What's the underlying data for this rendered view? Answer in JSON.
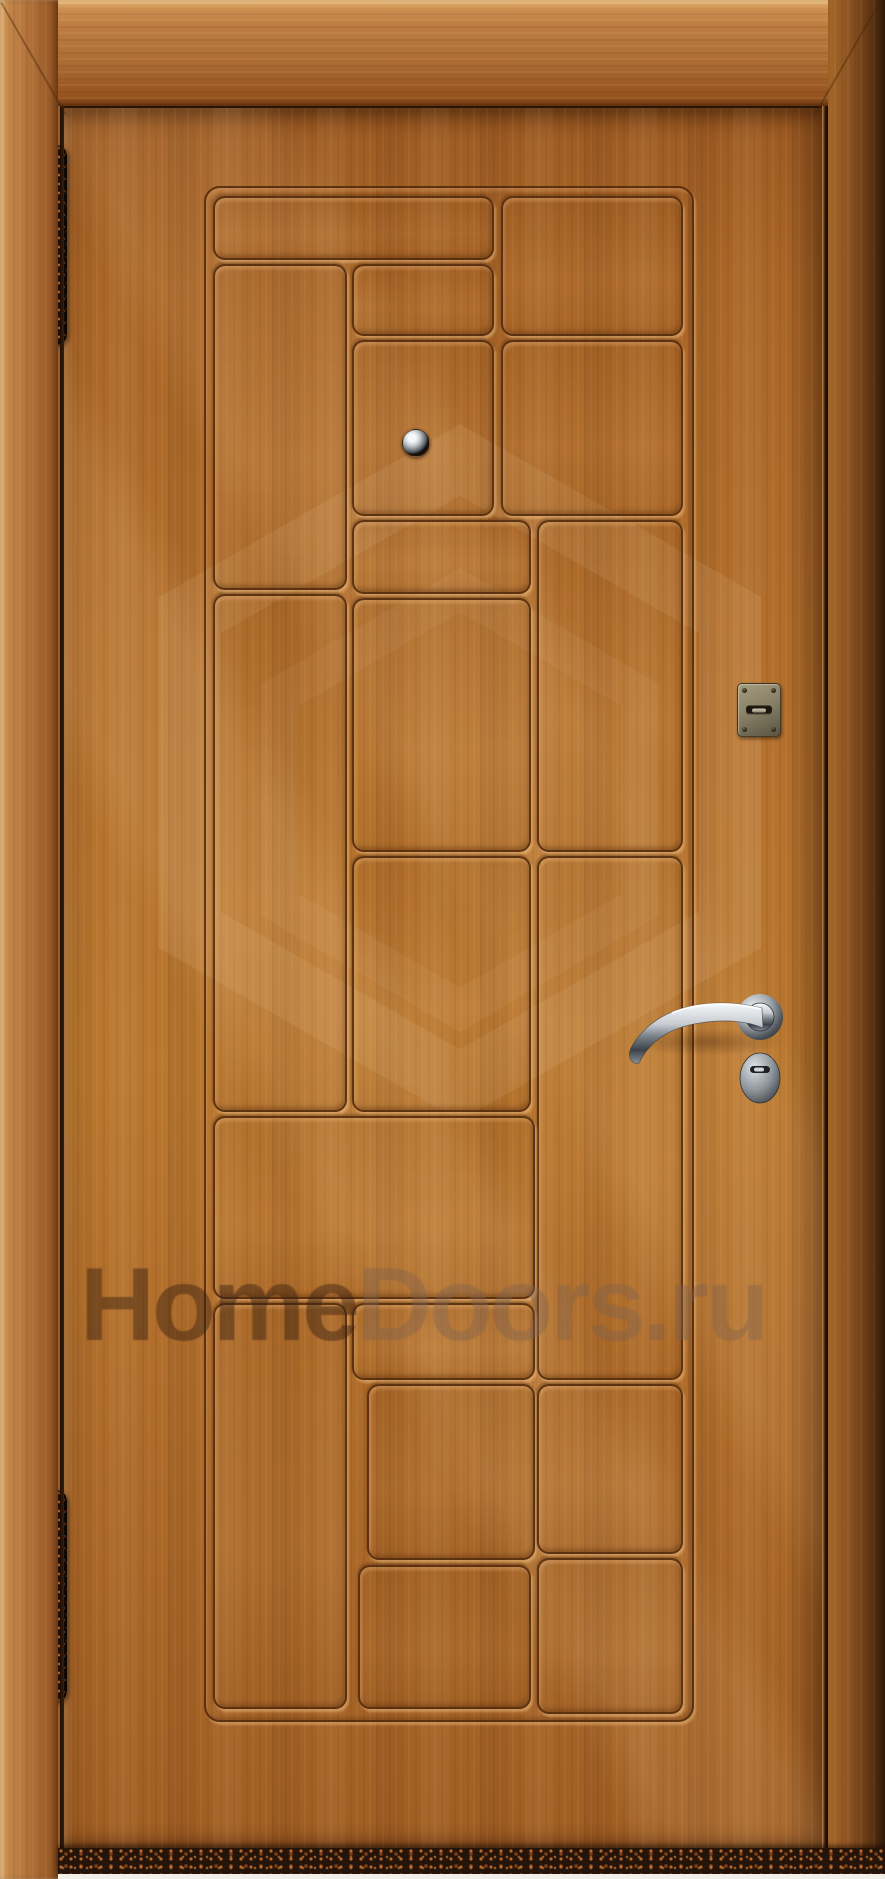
{
  "meta": {
    "subject": "Entrance door, golden-oak wood finish, decorative staggered rectangular panel pattern, front view product photo"
  },
  "watermark": {
    "text": "HomeDoors.ru",
    "primary": "Home",
    "secondary": "Doors.ru"
  },
  "palette": {
    "leaf_wood": "#b5722e",
    "frame_wood": "#b5753c",
    "groove_dark": "#542c0e",
    "groove_highlight": "#facA8c",
    "threshold_dark": "#241409",
    "threshold_speckle": "#c9702f",
    "chrome_light": "#f6f8f9",
    "chrome_dark": "#3c4248",
    "plate_metal": "#8b8368"
  },
  "layout": {
    "scene": {
      "x": 0,
      "y": 0,
      "w": 885,
      "h": 1879
    },
    "leaf": {
      "x": 64,
      "y": 108,
      "w": 759,
      "h": 1740
    },
    "outer_groove": {
      "x": 204,
      "y": 186,
      "w": 486,
      "h": 1532
    },
    "wm_text_pos": {
      "x": 80,
      "y": 1246
    },
    "threshold": {
      "x": 58,
      "y": 1848,
      "w": 827,
      "h": 26
    }
  },
  "panels": [
    {
      "x": 213,
      "y": 196,
      "w": 277,
      "h": 60
    },
    {
      "x": 501,
      "y": 196,
      "w": 178,
      "h": 136
    },
    {
      "x": 213,
      "y": 264,
      "w": 130,
      "h": 322
    },
    {
      "x": 352,
      "y": 264,
      "w": 138,
      "h": 68
    },
    {
      "x": 352,
      "y": 340,
      "w": 138,
      "h": 172
    },
    {
      "x": 501,
      "y": 340,
      "w": 178,
      "h": 172
    },
    {
      "x": 352,
      "y": 520,
      "w": 175,
      "h": 70
    },
    {
      "x": 537,
      "y": 520,
      "w": 142,
      "h": 328
    },
    {
      "x": 213,
      "y": 594,
      "w": 130,
      "h": 514
    },
    {
      "x": 352,
      "y": 598,
      "w": 175,
      "h": 250
    },
    {
      "x": 352,
      "y": 856,
      "w": 175,
      "h": 252
    },
    {
      "x": 537,
      "y": 856,
      "w": 142,
      "h": 520
    },
    {
      "x": 213,
      "y": 1116,
      "w": 318,
      "h": 179
    },
    {
      "x": 213,
      "y": 1303,
      "w": 130,
      "h": 402
    },
    {
      "x": 352,
      "y": 1303,
      "w": 179,
      "h": 73
    },
    {
      "x": 367,
      "y": 1384,
      "w": 164,
      "h": 172
    },
    {
      "x": 537,
      "y": 1384,
      "w": 142,
      "h": 166
    },
    {
      "x": 358,
      "y": 1565,
      "w": 169,
      "h": 140
    },
    {
      "x": 537,
      "y": 1558,
      "w": 142,
      "h": 152
    }
  ],
  "hardware": {
    "peephole": {
      "x": 402,
      "y": 429,
      "w": 26,
      "h": 26
    },
    "keyhole_plate": {
      "x": 737,
      "y": 683,
      "w": 42,
      "h": 52
    },
    "handle_area": {
      "x": 612,
      "y": 980,
      "w": 200,
      "h": 135
    },
    "hinge_top": {
      "x": 44,
      "y": 145,
      "w": 23,
      "h": 200
    },
    "hinge_bottom": {
      "x": 44,
      "y": 1490,
      "w": 23,
      "h": 212
    }
  }
}
